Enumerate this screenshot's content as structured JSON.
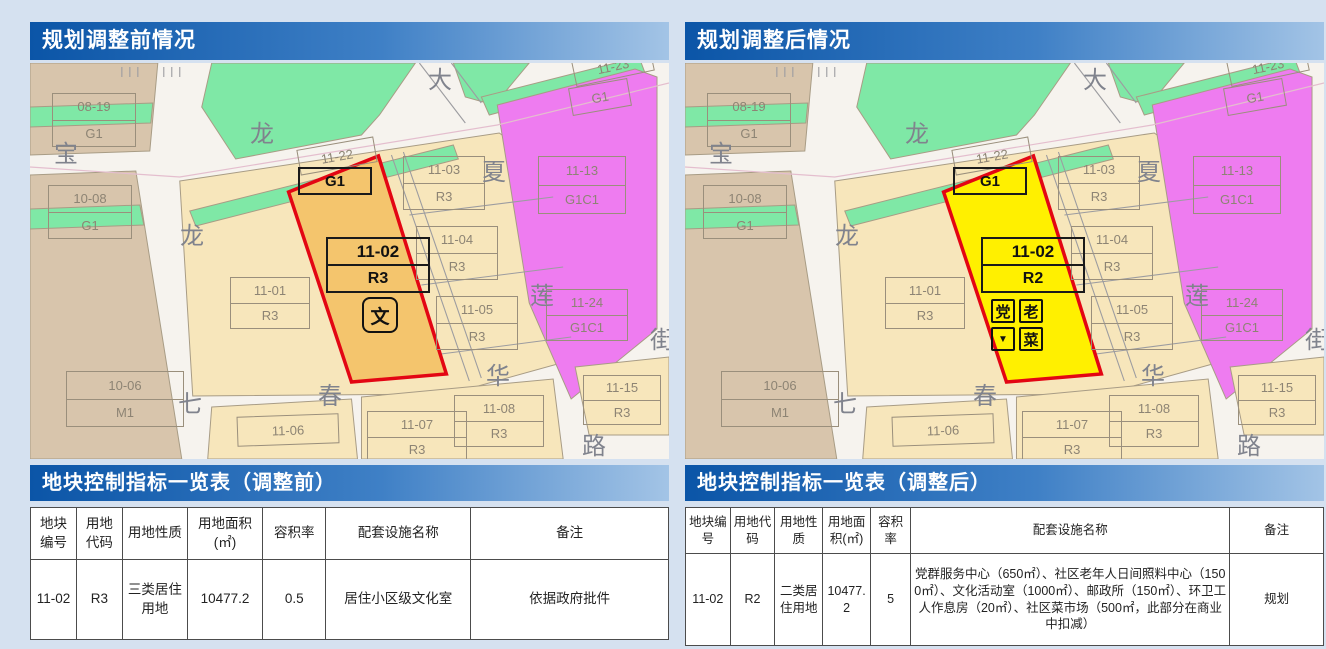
{
  "colors": {
    "road": "#f6f3ee",
    "tan": "#d8c5ac",
    "green": "#7fe8a6",
    "cream": "#f7e6bb",
    "magenta": "#ee7cf0",
    "parcel_stroke": "#a89c85",
    "road_line": "#9c9ca0",
    "pink_line": "#e4bece",
    "red_border": "#e30613",
    "page_bg": "#d5e1f0",
    "label_text": "#8d8474",
    "street_text": "#80838d"
  },
  "panels": [
    {
      "header": "规划调整前情况",
      "table_title": "地块控制指标一览表（调整前）",
      "parcel_fill": "#f4c56d",
      "parcel_use": "R3",
      "icons": [
        {
          "glyph": "文",
          "name": "culture-room-icon",
          "x": 332,
          "y": 234,
          "w": 36,
          "h": 36,
          "fs": 19,
          "r": 8
        }
      ],
      "table_row": [
        "11-02",
        "R3",
        "三类居住用地",
        "10477.2",
        "0.5",
        "居住小区级文化室",
        "依据政府批件"
      ]
    },
    {
      "header": "规划调整后情况",
      "table_title": "地块控制指标一览表（调整后）",
      "parcel_fill": "#fff000",
      "parcel_use": "R2",
      "icons": [
        {
          "glyph": "党",
          "name": "party-service-icon",
          "x": 306,
          "y": 236,
          "w": 24,
          "h": 24,
          "fs": 15,
          "r": 2
        },
        {
          "glyph": "老",
          "name": "elderly-care-icon",
          "x": 334,
          "y": 236,
          "w": 24,
          "h": 24,
          "fs": 15,
          "r": 2
        },
        {
          "glyph": "▼",
          "name": "flag-icon",
          "x": 306,
          "y": 264,
          "w": 24,
          "h": 24,
          "fs": 10,
          "r": 2
        },
        {
          "glyph": "菜",
          "name": "market-icon",
          "x": 334,
          "y": 264,
          "w": 24,
          "h": 24,
          "fs": 15,
          "r": 2
        }
      ],
      "table_row": [
        "11-02",
        "R2",
        "二类居住用地",
        "10477.2",
        "5",
        "党群服务中心（650㎡）、社区老年人日间照料中心（1500㎡）、文化活动室（1000㎡）、邮政所（150㎡）、环卫工人作息房（20㎡）、社区菜市场（500㎡，此部分在商业中扣减）",
        "规划"
      ]
    }
  ],
  "table_columns": [
    "地块编号",
    "用地代码",
    "用地性质",
    "用地面积(㎡)",
    "容积率",
    "配套设施名称",
    "备注"
  ],
  "map": {
    "highlight_code": "11-02",
    "g1_label": "G1",
    "parcel_labels": [
      {
        "code": "08-19",
        "sub": "G1",
        "x": 22,
        "y": 30,
        "w": 84,
        "h": 54
      },
      {
        "code": "10-08",
        "sub": "G1",
        "x": 18,
        "y": 122,
        "w": 84,
        "h": 54
      },
      {
        "code": "10-06",
        "sub": "M1",
        "x": 36,
        "y": 308,
        "w": 118,
        "h": 56
      },
      {
        "code": "11-01",
        "sub": "R3",
        "x": 200,
        "y": 214,
        "w": 80,
        "h": 52
      },
      {
        "code": "11-03",
        "sub": "R3",
        "x": 373,
        "y": 93,
        "w": 82,
        "h": 54
      },
      {
        "code": "11-04",
        "sub": "R3",
        "x": 386,
        "y": 163,
        "w": 82,
        "h": 54
      },
      {
        "code": "11-05",
        "sub": "R3",
        "x": 406,
        "y": 233,
        "w": 82,
        "h": 54
      },
      {
        "code": "11-13",
        "sub": "G1C1",
        "x": 508,
        "y": 93,
        "w": 88,
        "h": 58
      },
      {
        "code": "11-24",
        "sub": "G1C1",
        "x": 516,
        "y": 226,
        "w": 82,
        "h": 52
      },
      {
        "code": "11-08",
        "sub": "R3",
        "x": 424,
        "y": 332,
        "w": 90,
        "h": 52
      },
      {
        "code": "11-15",
        "sub": "R3",
        "x": 553,
        "y": 312,
        "w": 78,
        "h": 50
      },
      {
        "code": "11-07",
        "sub": "R3",
        "x": 337,
        "y": 348,
        "w": 100,
        "h": 52
      }
    ],
    "single_labels": [
      {
        "t": "11-06",
        "x": 207,
        "y": 352,
        "w": 102,
        "h": 30,
        "rot": -2
      },
      {
        "t": "11-22",
        "x": 268,
        "y": 80,
        "w": 78,
        "h": 26,
        "rot": -10
      },
      {
        "t": "11-23",
        "x": 543,
        "y": -10,
        "w": 80,
        "h": 26,
        "rot": -12
      },
      {
        "t": "G1",
        "x": 540,
        "y": 20,
        "w": 60,
        "h": 28,
        "rot": -10
      }
    ],
    "street_labels": [
      {
        "t": "宝",
        "x": 24,
        "y": 80
      },
      {
        "t": "龙",
        "x": 220,
        "y": 60
      },
      {
        "t": "龙",
        "x": 150,
        "y": 162
      },
      {
        "t": "大",
        "x": 398,
        "y": 6
      },
      {
        "t": "夏",
        "x": 452,
        "y": 98
      },
      {
        "t": "莲",
        "x": 500,
        "y": 222
      },
      {
        "t": "街",
        "x": 620,
        "y": 266
      },
      {
        "t": "七",
        "x": 148,
        "y": 330
      },
      {
        "t": "春",
        "x": 288,
        "y": 322
      },
      {
        "t": "华",
        "x": 456,
        "y": 302
      },
      {
        "t": "路",
        "x": 552,
        "y": 372
      }
    ]
  }
}
